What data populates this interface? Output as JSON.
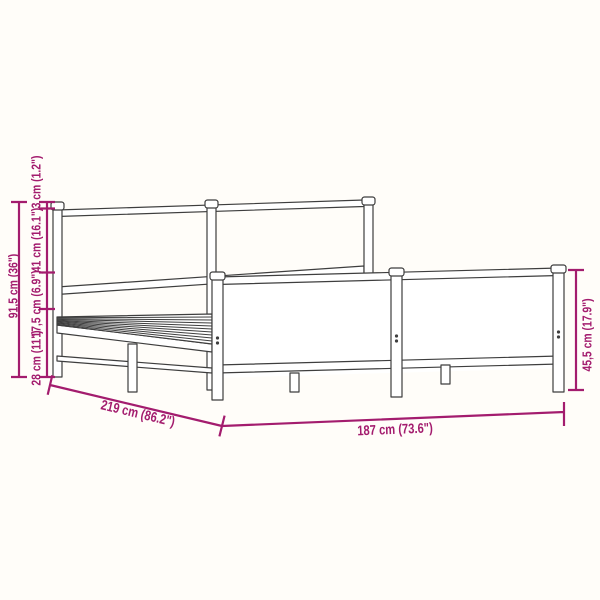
{
  "diagram": {
    "name": "metal-bed-frame-dimension-diagram",
    "labels": {
      "total_height": "91,5 cm (36\")",
      "top_section": "3 cm (1.2\")",
      "headboard_panel_height": "41 cm (16.1\")",
      "rail_to_platform": "17,5 cm (6.9\")",
      "platform_floor_clearance": "28 cm (11\")",
      "total_length": "219 cm (86.2\")",
      "total_width": "187 cm (73.6\")",
      "footboard_height": "45,5 cm (17.9\")"
    }
  },
  "colors": {
    "dimension": "#a31c6e",
    "line_art": "#3e3e3e",
    "background": "#fffdf9"
  }
}
